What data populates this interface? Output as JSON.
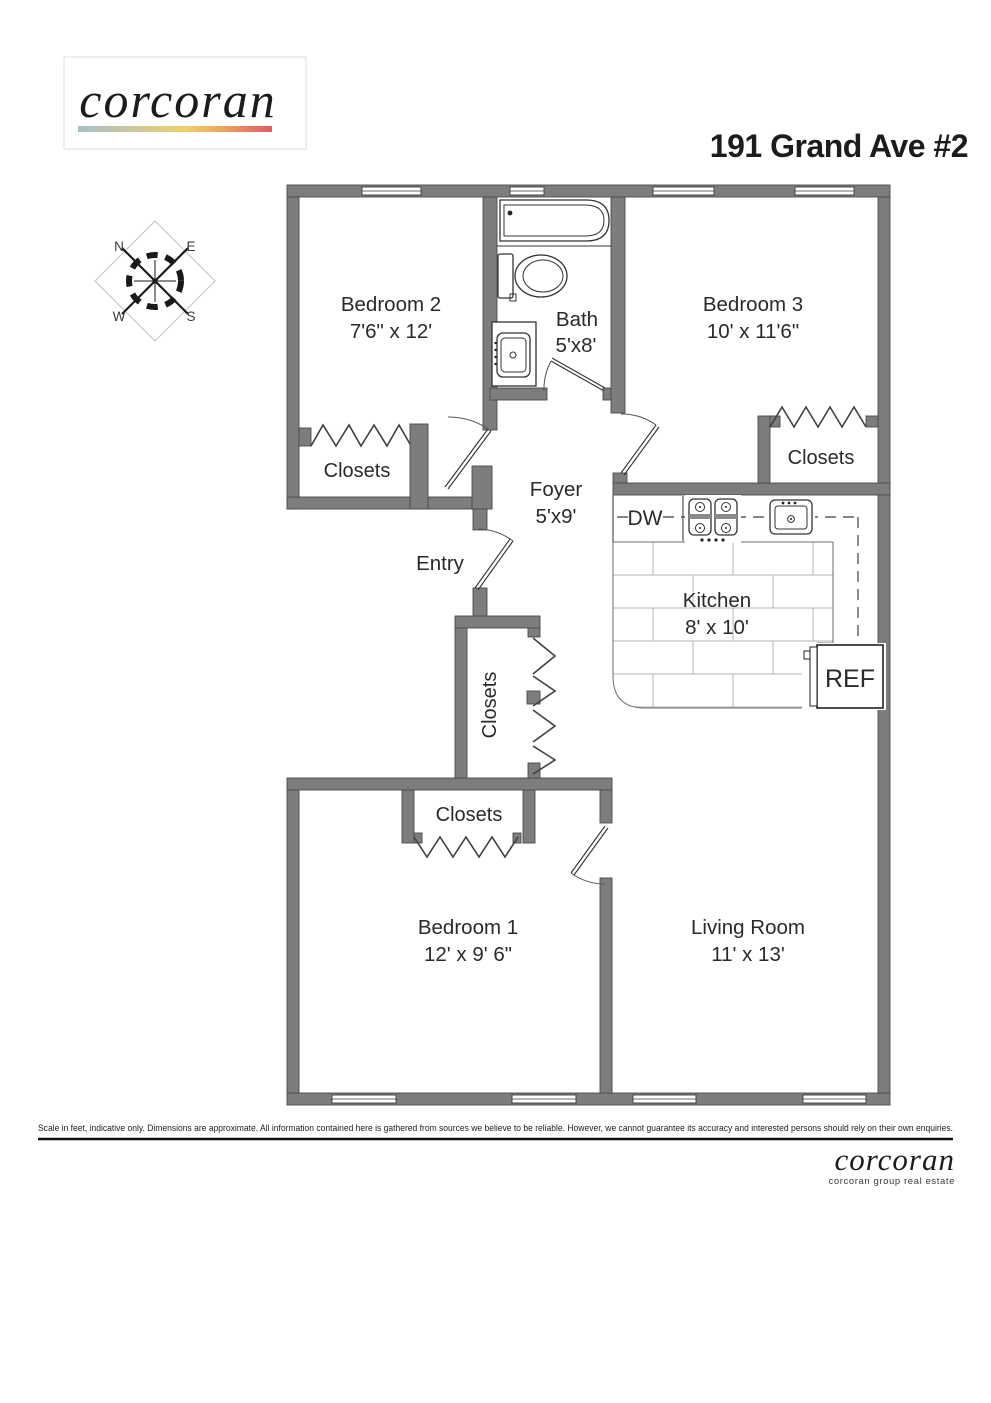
{
  "header": {
    "logo_text": "corcoran",
    "title": "191 Grand Ave #2"
  },
  "compass": {
    "north": "N",
    "east": "E",
    "west": "W",
    "south": "S"
  },
  "plan": {
    "rooms": {
      "bedroom2": {
        "name": "Bedroom 2",
        "dims": "7'6\" x 12'"
      },
      "bath": {
        "name": "Bath",
        "dims": "5'x8'"
      },
      "bedroom3": {
        "name": "Bedroom 3",
        "dims": "10' x 11'6\""
      },
      "foyer": {
        "name": "Foyer",
        "dims": "5'x9'"
      },
      "kitchen": {
        "name": "Kitchen",
        "dims": "8' x 10'"
      },
      "bedroom1": {
        "name": "Bedroom 1",
        "dims": "12' x 9' 6\""
      },
      "living_room": {
        "name": "Living Room",
        "dims": "11' x 13'"
      }
    },
    "labels": {
      "entry": "Entry",
      "closets_bedroom2": "Closets",
      "closets_bedroom3": "Closets",
      "closets_hall": "Closets",
      "closets_bedroom1": "Closets",
      "dishwasher": "DW",
      "refrigerator": "REF"
    }
  },
  "footer": {
    "disclaimer": "Scale in feet, indicative only. Dimensions are approximate. All information contained here is gathered from sources we believe to be reliable. However, we cannot guarantee its accuracy and interested persons should rely on their own enquiries.",
    "logo_text": "corcoran",
    "tagline": "corcoran group real estate"
  },
  "colors": {
    "wall": "#7d7d7d",
    "wall_outline": "#4a4a4a",
    "line": "#2a2a2a",
    "tile_line": "#b5b5b5",
    "logo_gradient": [
      "#a7bfc9",
      "#cfc79b",
      "#eed168",
      "#eca45a",
      "#e25b66"
    ]
  }
}
